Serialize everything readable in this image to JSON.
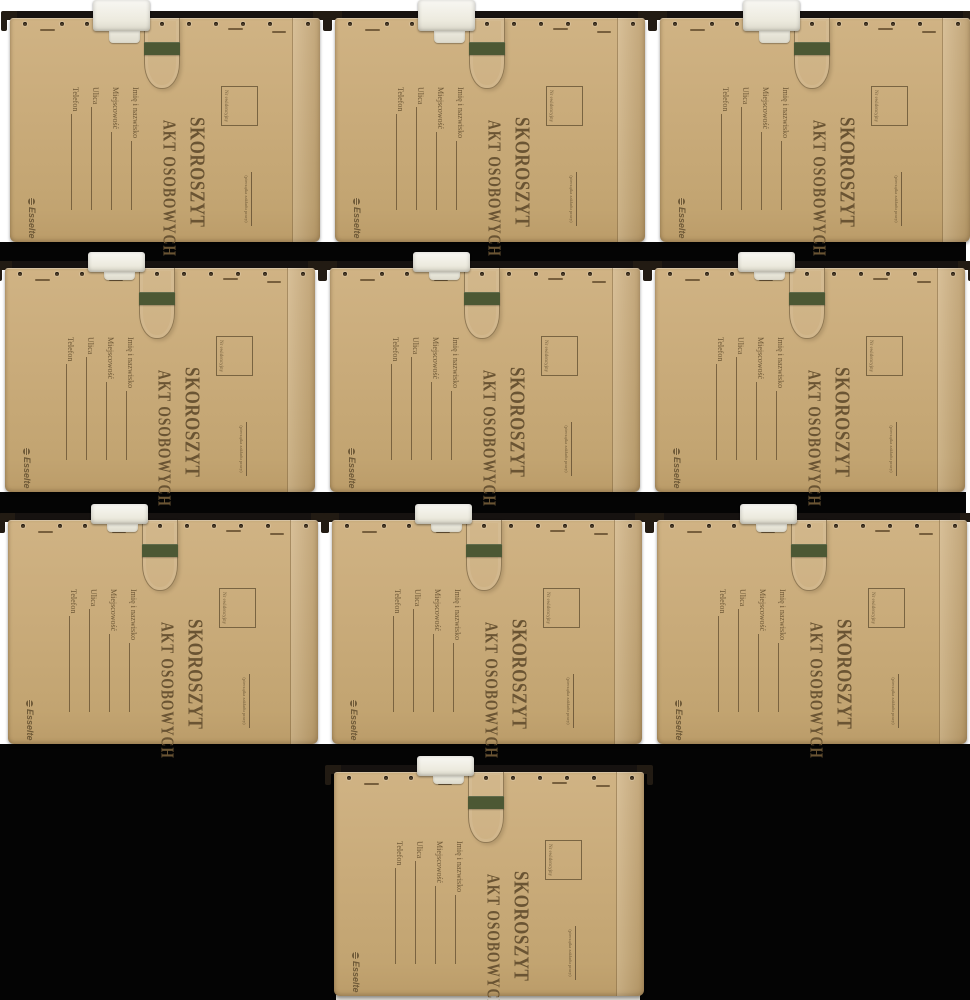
{
  "product": {
    "brand": "Esselte",
    "title_line1": "SKOROSZYT",
    "title_line2": "AKT OSOBOWYCH",
    "registry_box_label": "Nr ewidencyjny",
    "stamp_caption": "(pieczątka zakładu pracy)",
    "fields": [
      {
        "label": "Imię i nazwisko"
      },
      {
        "label": "Miejscowość"
      },
      {
        "label": "Ulica"
      },
      {
        "label": "Telefon"
      }
    ]
  },
  "colors": {
    "kraft": "#c9ab7a",
    "print_brown": "#6f5a38",
    "tab_green": "#4c5834",
    "clip_white": "#f1efe8",
    "hook_black": "#221b13",
    "gap_black": "#040404",
    "background": "#ffffff"
  },
  "layout": {
    "folder_count": 10,
    "grid_rows": "3 + 3 + 3 + 1",
    "folders": [
      {
        "x": 10,
        "y": 0
      },
      {
        "x": 335,
        "y": 0
      },
      {
        "x": 660,
        "y": 0
      },
      {
        "x": 5,
        "y": 250
      },
      {
        "x": 330,
        "y": 250
      },
      {
        "x": 655,
        "y": 250
      },
      {
        "x": 8,
        "y": 502
      },
      {
        "x": 332,
        "y": 502
      },
      {
        "x": 657,
        "y": 502
      },
      {
        "x": 334,
        "y": 754
      }
    ]
  }
}
